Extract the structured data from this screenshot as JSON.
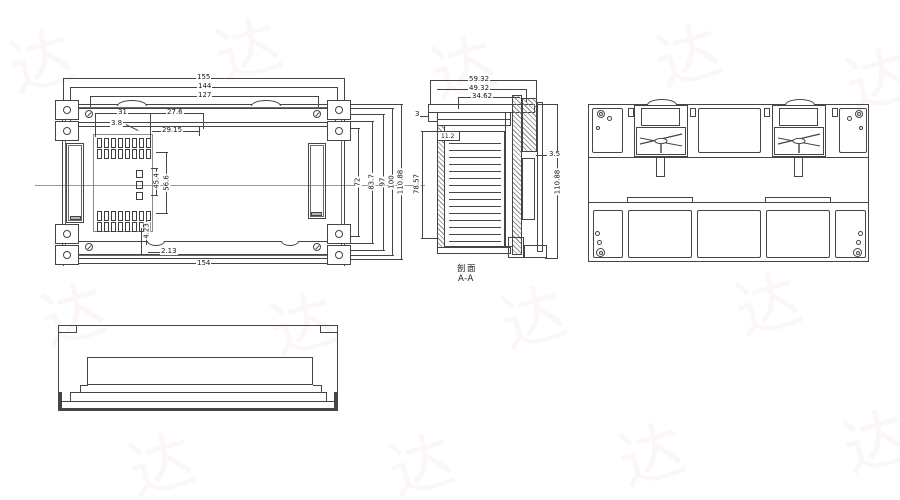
{
  "drawing": {
    "front": {
      "dim_155": "155",
      "dim_144": "144",
      "dim_127": "127",
      "dim_31": "31",
      "dim_27_6": "27.6",
      "dim_3_8": "3.8",
      "dim_29_15": "29.15",
      "dim_45_4": "45.4",
      "dim_56_6": "56.6",
      "dim_4_23": "4.23",
      "dim_2_13": "2.13",
      "dim_154": "154",
      "dim_72": "72",
      "dim_83_7": "83.7",
      "dim_97": "97",
      "dim_100": "100",
      "dim_110_88": "110.88"
    },
    "section": {
      "dim_59_32": "59.32",
      "dim_49_32": "49.32",
      "dim_34_62": "34.62",
      "dim_3": "3",
      "dim_11_2": "11.2",
      "dim_3_5": "3.5",
      "dim_78_57": "78.57",
      "dim_110_88": "110.88",
      "label": "剖面",
      "sublabel": "A-A"
    },
    "colors": {
      "line": "#454545",
      "dim_text": "#151515",
      "watermark": "#dd8888"
    },
    "watermark_glyph": "达"
  }
}
